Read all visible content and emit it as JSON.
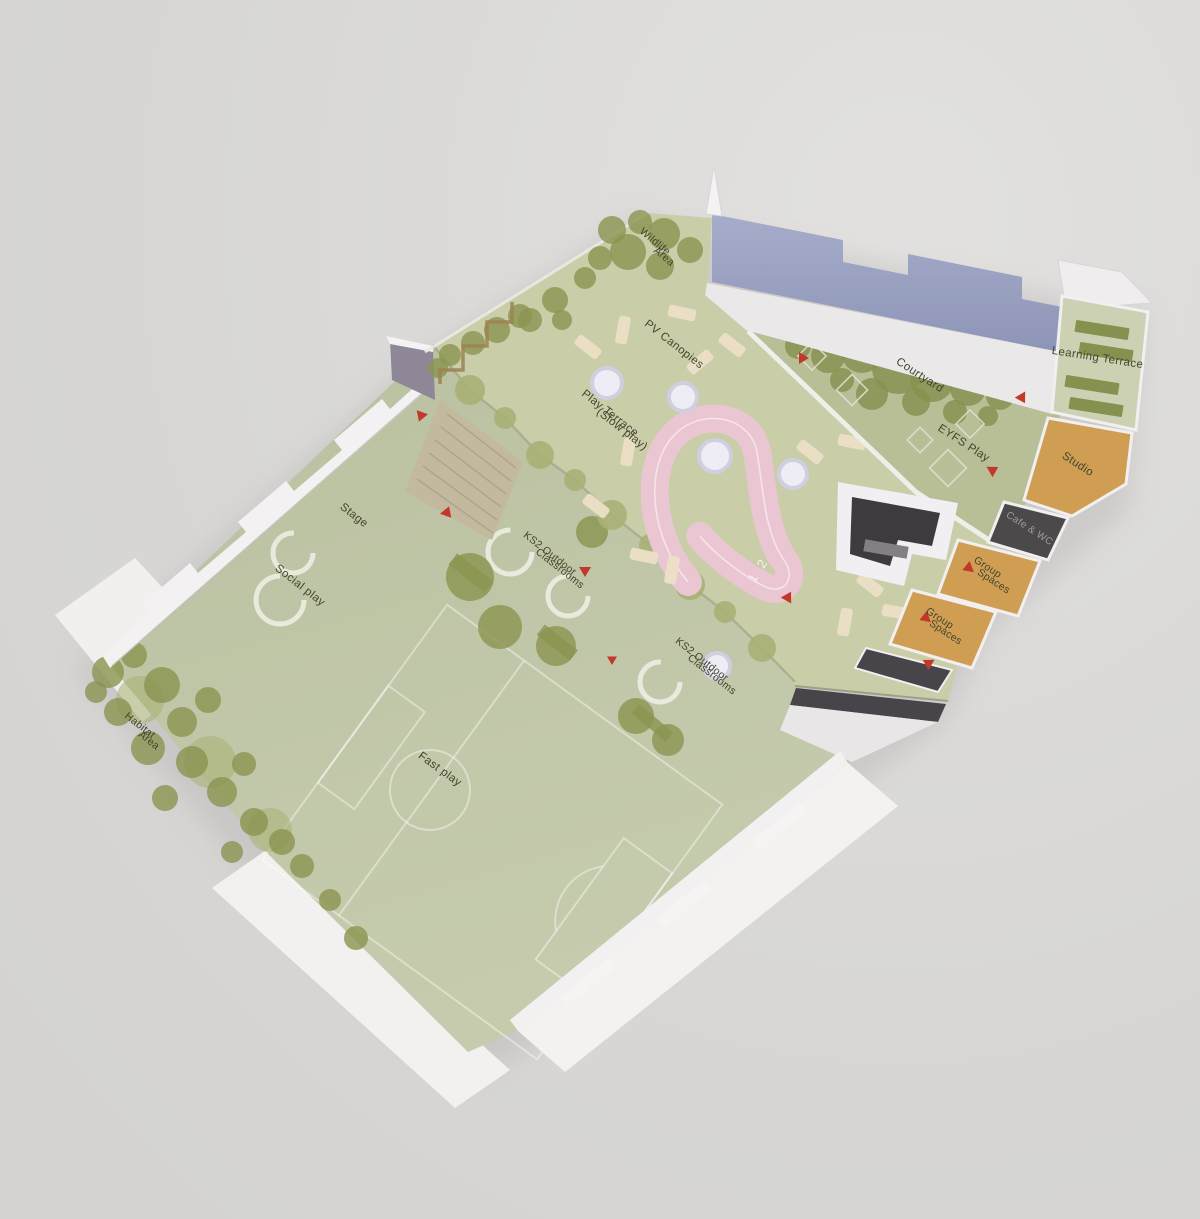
{
  "scene": {
    "kind": "photograph of a physical architectural site model of a school",
    "view": "aerial oblique, model rotated on a grey backdrop"
  },
  "labels": {
    "wildlife": [
      "Wildlife",
      "Area"
    ],
    "pv_canopies": "PV Canopies",
    "play_terrace": [
      "Play Terrace",
      "(Slow play)"
    ],
    "courtyard": "Courtyard",
    "eyfs_play": "EYFS Play",
    "learning_terrace": "Learning Terrace",
    "studio": "Studio",
    "cafe_wc": "Cafe & WC",
    "group_spaces": [
      "Group",
      "Spaces"
    ],
    "stage": "Stage",
    "social_play": "Social play",
    "ks2": [
      "KS2 Outdoor",
      "Classrooms"
    ],
    "fast_play": "Fast play",
    "habitat": [
      "Habitat",
      "Area"
    ],
    "lane_numbers": "1 2"
  },
  "colors": {
    "background": "#d8d7d5",
    "model_white": "#f2f0f1",
    "walkway_white": "#eae8e9",
    "wall_lavender": "#99a1c1",
    "terrace_green": "#c9cda8",
    "playground_green_top": "#b9c1a0",
    "playground_green_bottom": "#c6cbae",
    "courtyard_green": "#b8be95",
    "strip_green": "#bcc29e",
    "learning_terrace_green": "#cdd1b3",
    "bench_bar_green": "#85914e",
    "tree_olive": "#8b9350",
    "track_pink": "#eac6d3",
    "bench_cream": "#ecdfc6",
    "panel_orange": "#cf9e52",
    "panel_dark": "#4c494b",
    "void_dark": "#3e3a3e",
    "stairs_tan": "#c3b99f",
    "marker_red": "#c0392b",
    "label_text": "#43452f"
  }
}
